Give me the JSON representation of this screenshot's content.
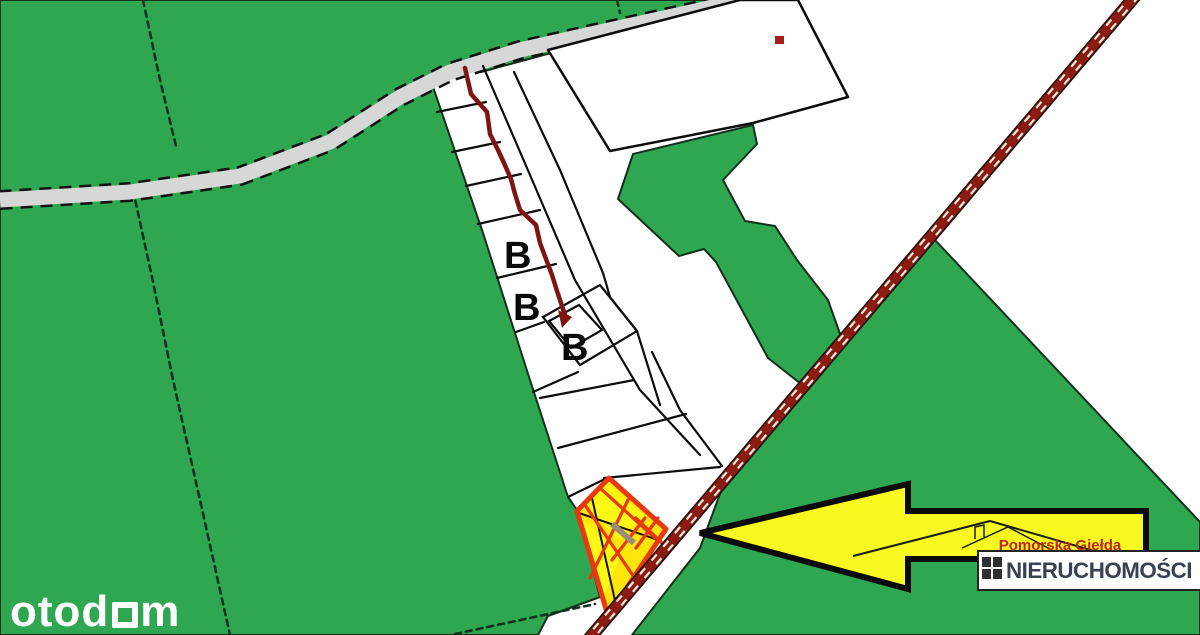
{
  "labels": {
    "b1": "B",
    "b2": "B",
    "b3": "B"
  },
  "watermark": {
    "part1": "otod",
    "part2": "m"
  },
  "agency": {
    "name_top": "Pomorska Giełda",
    "name_bottom": "NIERUCHOMOŚCI"
  },
  "colors": {
    "field_green": "#2fa750",
    "road_gray": "#d7d7d7",
    "railway_red": "#8c1b12",
    "boundary_red": "#7d1513",
    "parcel_yellow": "#ffe60a",
    "parcel_hatch": "#e8380f",
    "arrow_yellow": "#f8f821",
    "logo_red": "#c2251c",
    "logo_navy": "#3a4150"
  }
}
